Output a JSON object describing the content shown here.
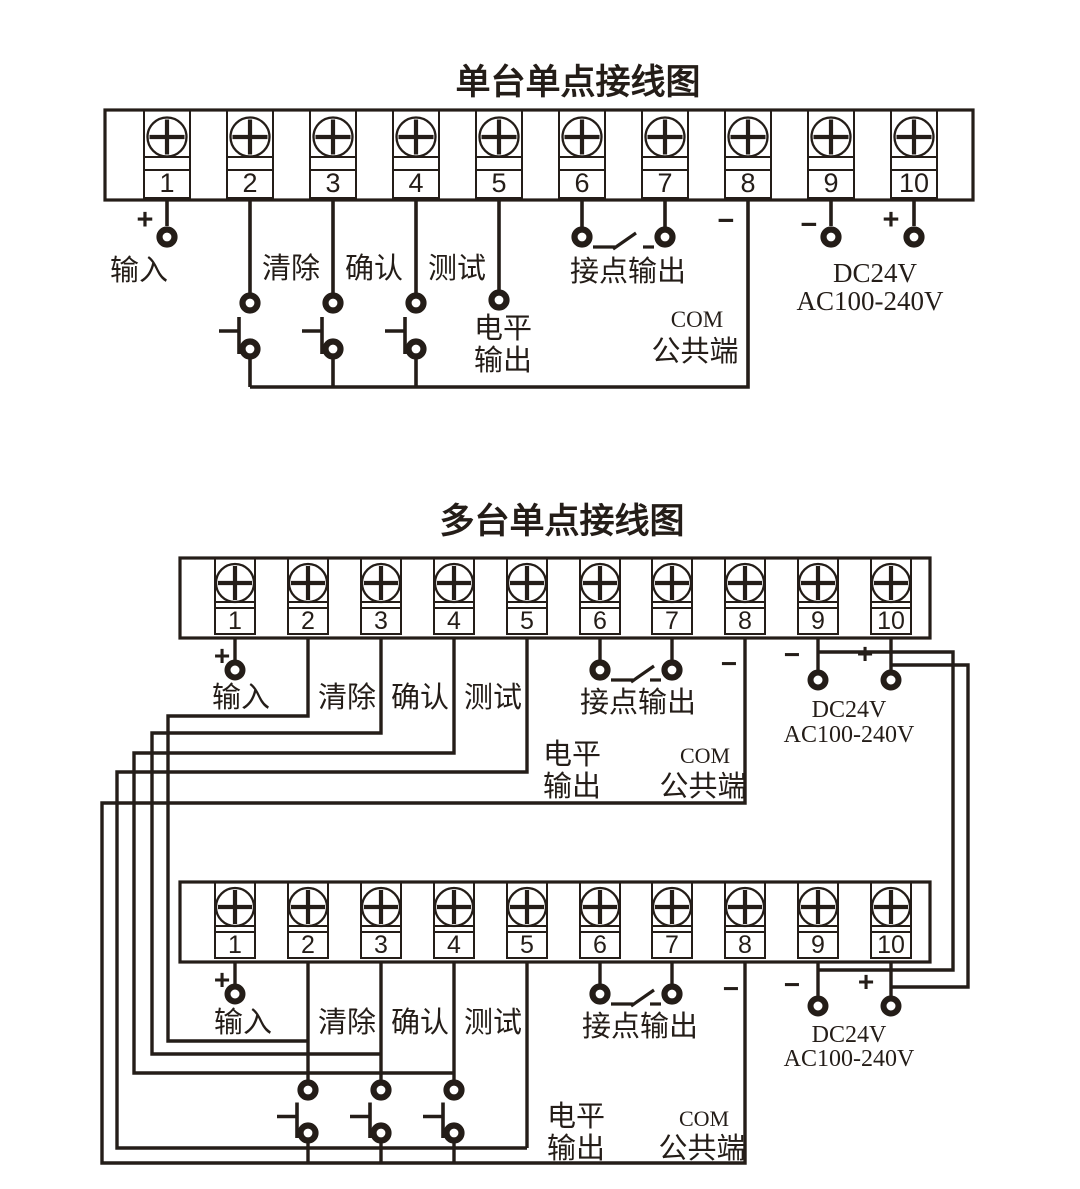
{
  "canvas": {
    "width": 1080,
    "height": 1189,
    "background": "#ffffff",
    "ink": "#241d18"
  },
  "terminal_numbers": [
    "1",
    "2",
    "3",
    "4",
    "5",
    "6",
    "7",
    "8",
    "9",
    "10"
  ],
  "labels": {
    "plus": "+",
    "minus": "−",
    "input": "输入",
    "clear": "清除",
    "confirm": "确认",
    "test": "测试",
    "level_line1": "电平",
    "level_line2": "输出",
    "contact_output": "接点输出",
    "com_line1": "COM",
    "com_line2": "公共端",
    "power_line1": "DC24V",
    "power_line2": "AC100-240V"
  },
  "diagrams": [
    {
      "key": "single-unit",
      "title": "单台单点接线图",
      "units": 1
    },
    {
      "key": "multi-unit",
      "title": "多台单点接线图",
      "units": 2
    }
  ]
}
